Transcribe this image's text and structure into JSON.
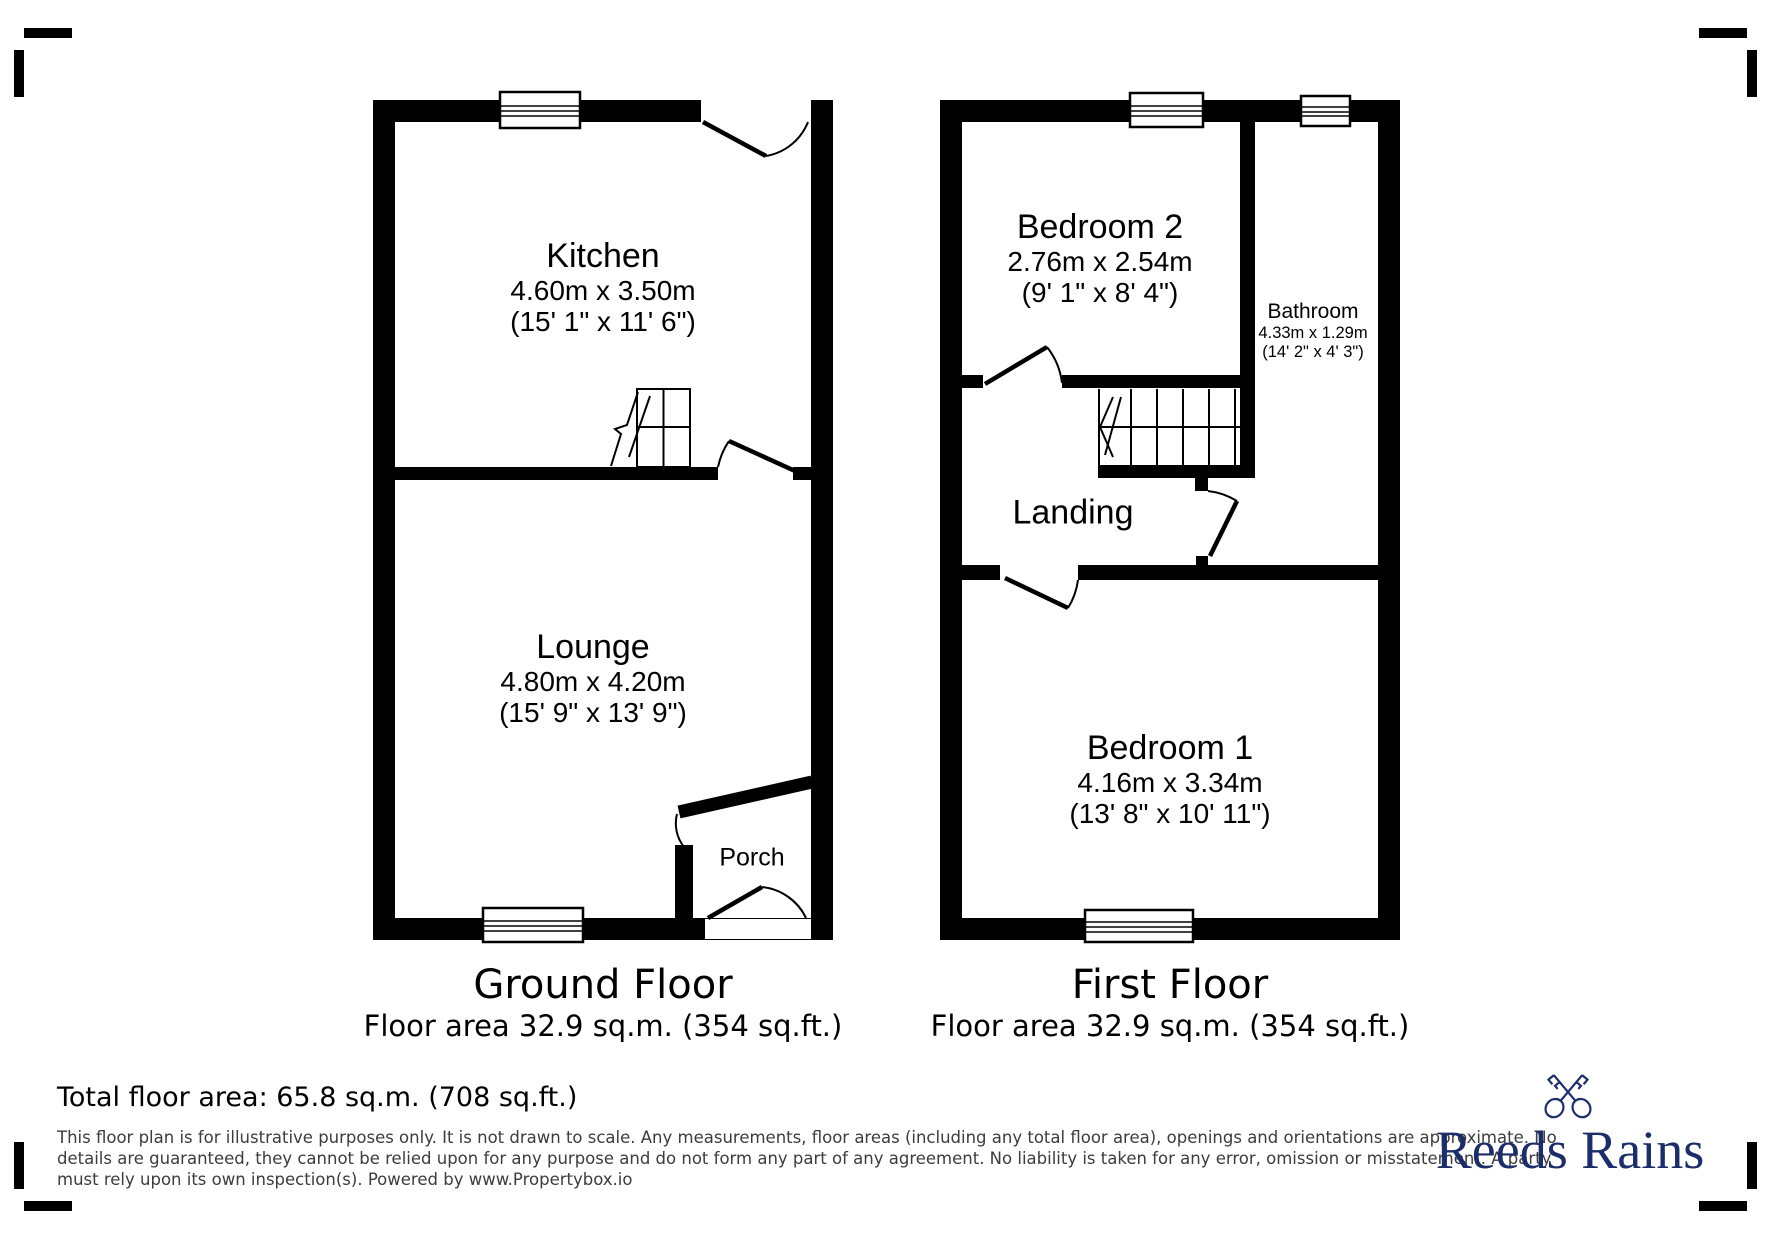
{
  "ground_floor": {
    "title": "Ground Floor",
    "area_label": "Floor area 32.9 sq.m. (354 sq.ft.)",
    "rooms": {
      "kitchen": {
        "name": "Kitchen",
        "metric": "4.60m x 3.50m",
        "imperial": "(15' 1\" x 11' 6\")"
      },
      "lounge": {
        "name": "Lounge",
        "metric": "4.80m x 4.20m",
        "imperial": "(15' 9\" x 13' 9\")"
      },
      "porch": {
        "name": "Porch"
      }
    }
  },
  "first_floor": {
    "title": "First Floor",
    "area_label": "Floor area 32.9 sq.m. (354 sq.ft.)",
    "rooms": {
      "bedroom2": {
        "name": "Bedroom 2",
        "metric": "2.76m x 2.54m",
        "imperial": "(9' 1\" x 8' 4\")"
      },
      "bathroom": {
        "name": "Bathroom",
        "metric": "4.33m x 1.29m",
        "imperial": "(14' 2\" x 4' 3\")"
      },
      "landing": {
        "name": "Landing"
      },
      "bedroom1": {
        "name": "Bedroom 1",
        "metric": "4.16m x 3.34m",
        "imperial": "(13' 8\" x 10' 11\")"
      }
    }
  },
  "footer": {
    "total_area": "Total floor area: 65.8 sq.m. (708 sq.ft.)",
    "disclaimer": {
      "line1": "This floor plan is for illustrative purposes only. It is not drawn to scale. Any measurements, floor areas (including any total floor area), openings and orientations are approximate. No",
      "line2": "details are guaranteed, they cannot be relied upon for any purpose and do not form any part of any agreement. No liability is taken for any error, omission or misstatement. A party",
      "line3": "must rely upon its own inspection(s). Powered by www.Propertybox.io"
    }
  },
  "logo": {
    "brand": "Reeds Rains",
    "color": "#1b2d6b"
  }
}
